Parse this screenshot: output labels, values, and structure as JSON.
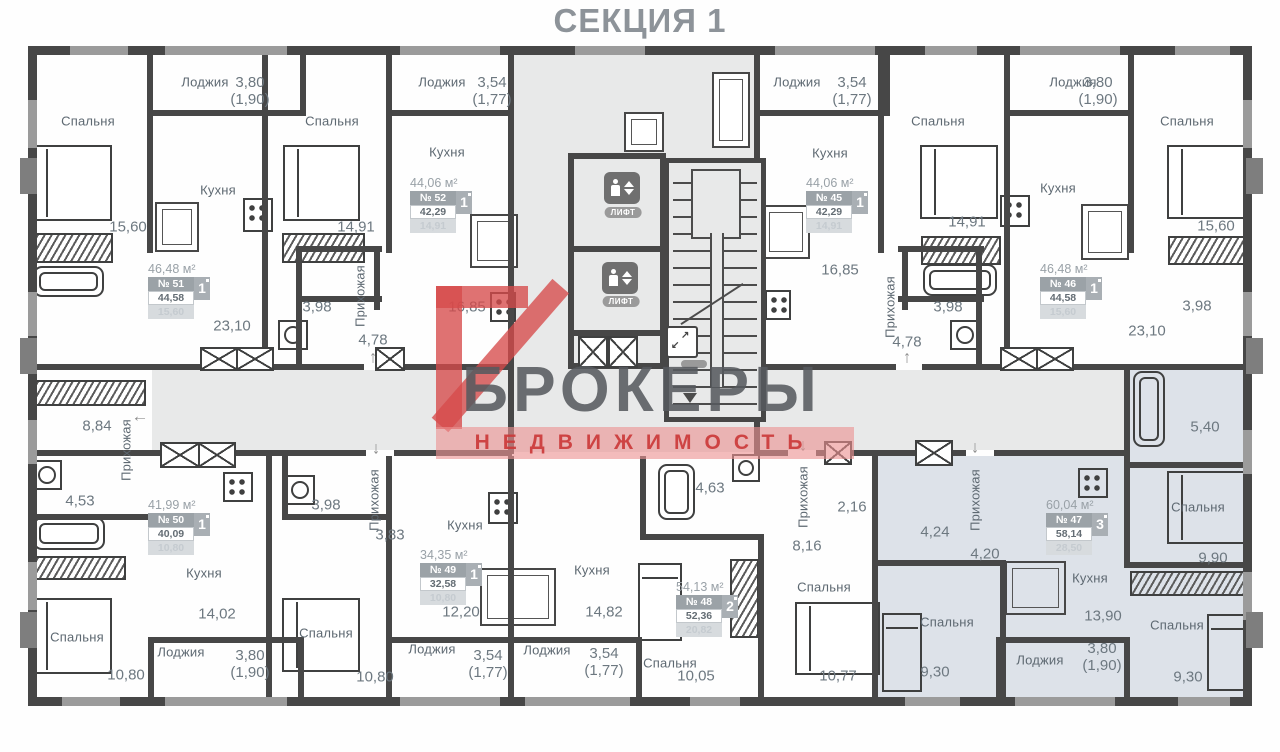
{
  "title": "СЕКЦИЯ 1",
  "watermark": {
    "brand": "БРОКЕРЫ",
    "subtitle": "НЕДВИЖИМОСТЬ",
    "accent": "#d64a4a"
  },
  "core": {
    "elevator_label": "ЛИФТ"
  },
  "apartments": [
    {
      "total": "46,48 м²",
      "num": "№ 51",
      "rooms": "1",
      "living": "44,58",
      "extra": "15,60",
      "x": 148,
      "y": 262
    },
    {
      "total": "44,06 м²",
      "num": "№ 52",
      "rooms": "1",
      "living": "42,29",
      "extra": "14,91",
      "x": 410,
      "y": 176
    },
    {
      "total": "44,06 м²",
      "num": "№ 45",
      "rooms": "1",
      "living": "42,29",
      "extra": "14,91",
      "x": 806,
      "y": 176
    },
    {
      "total": "46,48 м²",
      "num": "№ 46",
      "rooms": "1",
      "living": "44,58",
      "extra": "15,60",
      "x": 1040,
      "y": 262
    },
    {
      "total": "41,99 м²",
      "num": "№ 50",
      "rooms": "1",
      "living": "40,09",
      "extra": "10,80",
      "x": 148,
      "y": 498
    },
    {
      "total": "34,35 м²",
      "num": "№ 49",
      "rooms": "1",
      "living": "32,58",
      "extra": "10,80",
      "x": 420,
      "y": 548
    },
    {
      "total": "54,13 м²",
      "num": "№ 48",
      "rooms": "2",
      "living": "52,36",
      "extra": "20,82",
      "x": 676,
      "y": 580
    },
    {
      "total": "60,04 м²",
      "num": "№ 47",
      "rooms": "3",
      "living": "58,14",
      "extra": "28,50",
      "x": 1046,
      "y": 498
    }
  ],
  "room_labels": [
    {
      "t": "Спальня",
      "x": 88,
      "y": 121
    },
    {
      "t": "Кухня",
      "x": 218,
      "y": 190
    },
    {
      "t": "Лоджия",
      "x": 205,
      "y": 82
    },
    {
      "t": "Спальня",
      "x": 332,
      "y": 121
    },
    {
      "t": "Кухня",
      "x": 447,
      "y": 152
    },
    {
      "t": "Лоджия",
      "x": 442,
      "y": 82
    },
    {
      "t": "Спальня",
      "x": 938,
      "y": 121
    },
    {
      "t": "Кухня",
      "x": 830,
      "y": 153
    },
    {
      "t": "Лоджия",
      "x": 797,
      "y": 82
    },
    {
      "t": "Спальня",
      "x": 1187,
      "y": 121
    },
    {
      "t": "Кухня",
      "x": 1058,
      "y": 188
    },
    {
      "t": "Лоджия",
      "x": 1073,
      "y": 82
    },
    {
      "t": "Кухня",
      "x": 204,
      "y": 573
    },
    {
      "t": "Спальня",
      "x": 77,
      "y": 637
    },
    {
      "t": "Лоджия",
      "x": 181,
      "y": 652
    },
    {
      "t": "Кухня",
      "x": 465,
      "y": 525
    },
    {
      "t": "Спальня",
      "x": 326,
      "y": 633
    },
    {
      "t": "Лоджия",
      "x": 432,
      "y": 649
    },
    {
      "t": "Кухня",
      "x": 592,
      "y": 570
    },
    {
      "t": "Спальня",
      "x": 670,
      "y": 663
    },
    {
      "t": "Лоджия",
      "x": 547,
      "y": 650
    },
    {
      "t": "Спальня",
      "x": 824,
      "y": 587
    },
    {
      "t": "Кухня",
      "x": 1090,
      "y": 578
    },
    {
      "t": "Спальня",
      "x": 947,
      "y": 622
    },
    {
      "t": "Спальня",
      "x": 1198,
      "y": 507
    },
    {
      "t": "Спальня",
      "x": 1177,
      "y": 625
    },
    {
      "t": "Лоджия",
      "x": 1040,
      "y": 660
    },
    {
      "t": "Прихожая",
      "x": 360,
      "y": 296,
      "v": true
    },
    {
      "t": "Прихожая",
      "x": 890,
      "y": 307,
      "v": true
    },
    {
      "t": "Прихожая",
      "x": 126,
      "y": 450,
      "v": true
    },
    {
      "t": "Прихожая",
      "x": 374,
      "y": 500,
      "v": true
    },
    {
      "t": "Прихожая",
      "x": 803,
      "y": 497,
      "v": true
    },
    {
      "t": "Прихожая",
      "x": 975,
      "y": 500,
      "v": true
    }
  ],
  "dim_labels": [
    {
      "t": "15,60",
      "x": 128,
      "y": 228
    },
    {
      "t": "23,10",
      "x": 232,
      "y": 327
    },
    {
      "t": "3,80\n(1,90)",
      "x": 250,
      "y": 92
    },
    {
      "t": "14,91",
      "x": 356,
      "y": 228
    },
    {
      "t": "3,54\n(1,77)",
      "x": 492,
      "y": 92
    },
    {
      "t": "16,85",
      "x": 467,
      "y": 308
    },
    {
      "t": "3,98",
      "x": 317,
      "y": 308
    },
    {
      "t": "4,78",
      "x": 373,
      "y": 341
    },
    {
      "t": "3,54\n(1,77)",
      "x": 852,
      "y": 92
    },
    {
      "t": "16,85",
      "x": 840,
      "y": 271
    },
    {
      "t": "14,91",
      "x": 967,
      "y": 223
    },
    {
      "t": "3,98",
      "x": 948,
      "y": 308
    },
    {
      "t": "4,78",
      "x": 907,
      "y": 343
    },
    {
      "t": "3,80\n(1,90)",
      "x": 1098,
      "y": 92
    },
    {
      "t": "15,60",
      "x": 1216,
      "y": 227
    },
    {
      "t": "23,10",
      "x": 1147,
      "y": 332
    },
    {
      "t": "3,98",
      "x": 1197,
      "y": 307
    },
    {
      "t": "8,84",
      "x": 97,
      "y": 427
    },
    {
      "t": "4,53",
      "x": 80,
      "y": 502
    },
    {
      "t": "14,02",
      "x": 217,
      "y": 615
    },
    {
      "t": "10,80",
      "x": 126,
      "y": 676
    },
    {
      "t": "3,80\n(1,90)",
      "x": 250,
      "y": 665
    },
    {
      "t": "3,98",
      "x": 326,
      "y": 506
    },
    {
      "t": "3,83",
      "x": 390,
      "y": 536
    },
    {
      "t": "12,20",
      "x": 461,
      "y": 613
    },
    {
      "t": "10,80",
      "x": 375,
      "y": 678
    },
    {
      "t": "3,54\n(1,77)",
      "x": 488,
      "y": 665
    },
    {
      "t": "14,82",
      "x": 604,
      "y": 613
    },
    {
      "t": "3,54\n(1,77)",
      "x": 604,
      "y": 663
    },
    {
      "t": "4,63",
      "x": 710,
      "y": 489
    },
    {
      "t": "2,16",
      "x": 852,
      "y": 508
    },
    {
      "t": "8,16",
      "x": 807,
      "y": 547
    },
    {
      "t": "10,05",
      "x": 696,
      "y": 677
    },
    {
      "t": "10,77",
      "x": 838,
      "y": 677
    },
    {
      "t": "5,40",
      "x": 1205,
      "y": 428
    },
    {
      "t": "9,90",
      "x": 1213,
      "y": 559
    },
    {
      "t": "4,24",
      "x": 935,
      "y": 533
    },
    {
      "t": "4,20",
      "x": 985,
      "y": 555
    },
    {
      "t": "13,90",
      "x": 1103,
      "y": 617
    },
    {
      "t": "9,30",
      "x": 935,
      "y": 673
    },
    {
      "t": "9,30",
      "x": 1188,
      "y": 678
    },
    {
      "t": "3,80\n(1,90)",
      "x": 1102,
      "y": 658
    }
  ],
  "arrows": [
    {
      "g": "↑",
      "x": 373,
      "y": 357
    },
    {
      "g": "↑",
      "x": 907,
      "y": 357
    },
    {
      "g": "←",
      "x": 140,
      "y": 416
    },
    {
      "g": "↓",
      "x": 376,
      "y": 448
    },
    {
      "g": "↓",
      "x": 803,
      "y": 445
    },
    {
      "g": "↓",
      "x": 975,
      "y": 447
    }
  ]
}
